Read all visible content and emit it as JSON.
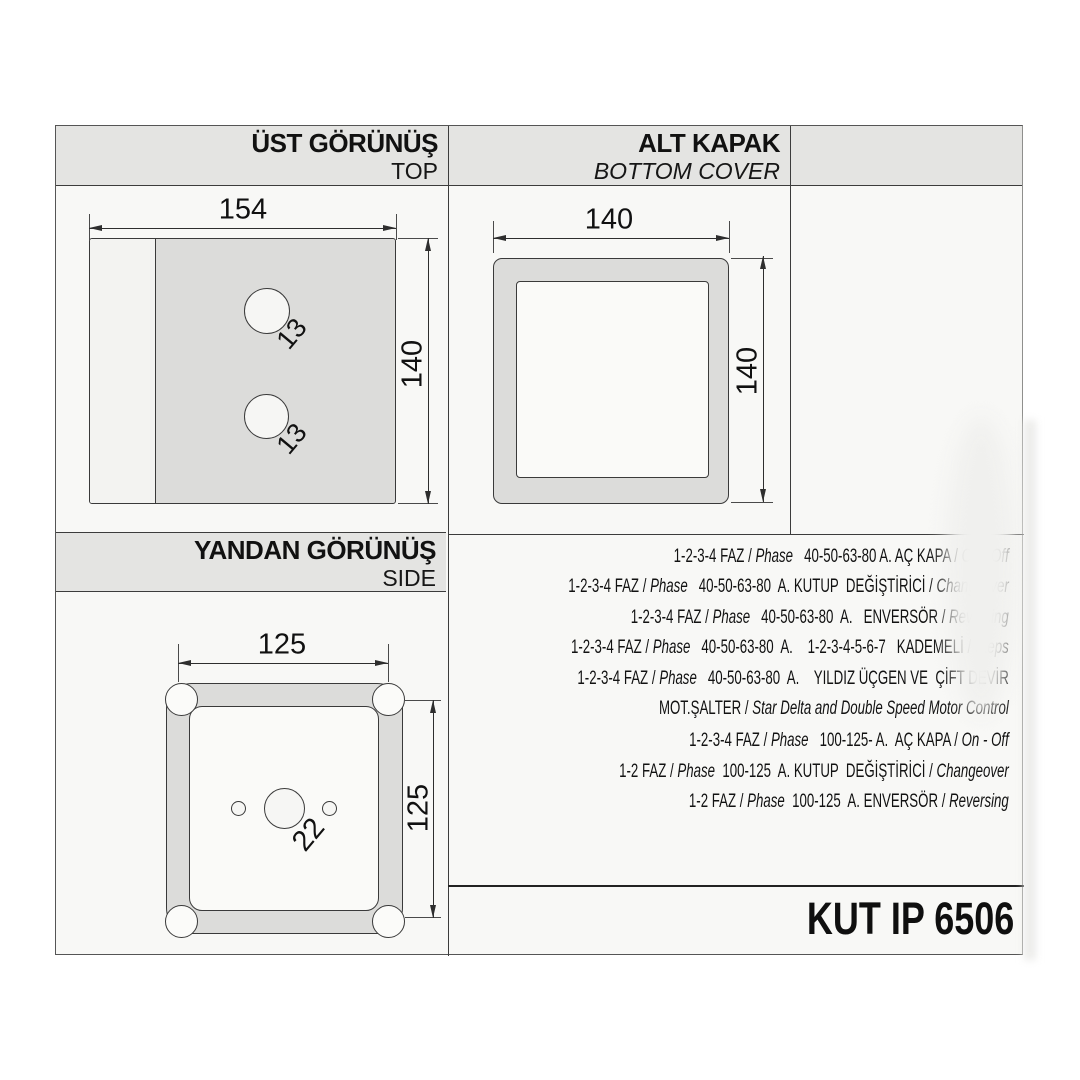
{
  "colors": {
    "band": "#e4e4e2",
    "drawing_fill": "#dcdcda",
    "line": "#2e2e2e",
    "paper": "#f8f8f6"
  },
  "sections": {
    "top_view": {
      "title_tr": "ÜST GÖRÜNÜŞ",
      "title_en": "TOP",
      "dims": {
        "width": "154",
        "height": "140",
        "hole_top": "13",
        "hole_bottom": "13"
      }
    },
    "bottom_cover": {
      "title_tr": "ALT KAPAK",
      "title_en": "BOTTOM COVER",
      "dims": {
        "width": "140",
        "height": "140"
      }
    },
    "side_view": {
      "title_tr": "YANDAN GÖRÜNÜŞ",
      "title_en": "SIDE",
      "dims": {
        "width": "125",
        "height": "125",
        "hole": "22"
      }
    }
  },
  "spec_lines": [
    [
      {
        "t": "1-2-3-4 FAZ / ",
        "i": false
      },
      {
        "t": "Phase",
        "i": true
      },
      {
        "t": "   40-50-63-80 A. AÇ KAPA / ",
        "i": false
      },
      {
        "t": "On - Off",
        "i": true
      }
    ],
    [
      {
        "t": "1-2-3-4 FAZ / ",
        "i": false
      },
      {
        "t": "Phase",
        "i": true
      },
      {
        "t": "   40-50-63-80  A. KUTUP  DEĞİŞTİRİCİ / ",
        "i": false
      },
      {
        "t": "Changeover",
        "i": true
      }
    ],
    [
      {
        "t": "1-2-3-4 FAZ / ",
        "i": false
      },
      {
        "t": "Phase",
        "i": true
      },
      {
        "t": "   40-50-63-80  A.   ENVERSÖR / ",
        "i": false
      },
      {
        "t": "Reversing",
        "i": true
      }
    ],
    [
      {
        "t": "1-2-3-4 FAZ / ",
        "i": false
      },
      {
        "t": "Phase",
        "i": true
      },
      {
        "t": "   40-50-63-80  A.    1-2-3-4-5-6-7   KADEMELİ / ",
        "i": false
      },
      {
        "t": "Steps",
        "i": true
      }
    ],
    [
      {
        "t": "1-2-3-4 FAZ / ",
        "i": false
      },
      {
        "t": "Phase",
        "i": true
      },
      {
        "t": "   40-50-63-80  A.    YILDIZ ÜÇGEN VE  ÇİFT DEVİR",
        "i": false
      }
    ],
    [
      {
        "t": "MOT.ŞALTER / ",
        "i": false
      },
      {
        "t": "Star Delta and Double Speed Motor Control",
        "i": true
      }
    ],
    [
      {
        "t": "1-2-3-4 FAZ / ",
        "i": false
      },
      {
        "t": "Phase",
        "i": true
      },
      {
        "t": "   100-125- A.  AÇ KAPA / ",
        "i": false
      },
      {
        "t": "On - Off",
        "i": true
      }
    ],
    [
      {
        "t": "1-2 FAZ / ",
        "i": false
      },
      {
        "t": "Phase",
        "i": true
      },
      {
        "t": "  100-125  A. KUTUP  DEĞİŞTİRİCİ / ",
        "i": false
      },
      {
        "t": "Changeover",
        "i": true
      }
    ],
    [
      {
        "t": "1-2 FAZ / ",
        "i": false
      },
      {
        "t": "Phase",
        "i": true
      },
      {
        "t": "  100-125  A. ENVERSÖR / ",
        "i": false
      },
      {
        "t": "Reversing",
        "i": true
      }
    ]
  ],
  "footer": {
    "product_code": "KUT IP 6506"
  }
}
